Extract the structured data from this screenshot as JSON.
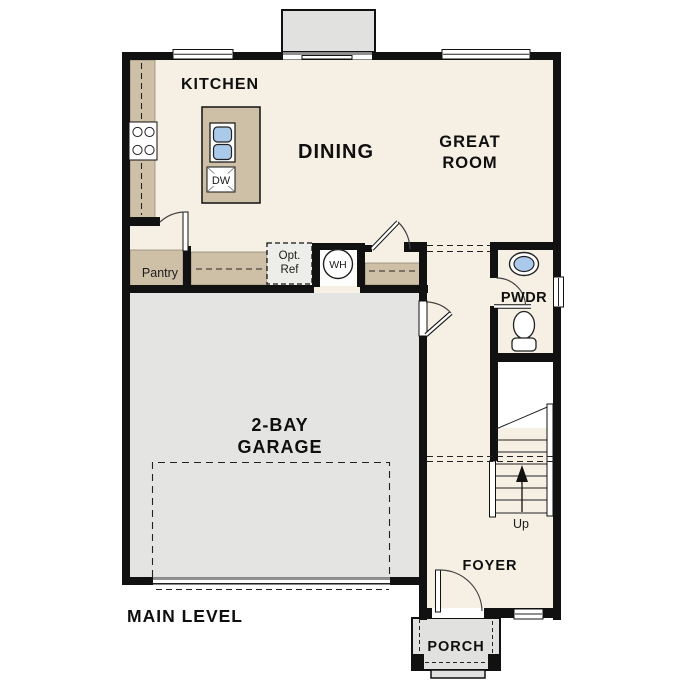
{
  "plan_title": "MAIN LEVEL",
  "rooms": {
    "kitchen": "KITCHEN",
    "dining": "DINING",
    "great_room_line1": "GREAT",
    "great_room_line2": "ROOM",
    "pantry": "Pantry",
    "powder_room": "PWDR",
    "garage_line1": "2-BAY",
    "garage_line2": "GARAGE",
    "foyer": "FOYER",
    "porch": "PORCH"
  },
  "fixtures": {
    "water_heater": "WH",
    "dishwasher": "DW",
    "optional_fridge_line1": "Opt.",
    "optional_fridge_line2": "Ref",
    "stairs_direction": "Up"
  },
  "colors": {
    "wall": "#111111",
    "floor": "#f6efe3",
    "garage": "#e4e4e2",
    "counter": "#cec0a7",
    "porch": "#e1e1df",
    "fixture-blue": "#abc9e8",
    "appliance": "#ededea"
  }
}
